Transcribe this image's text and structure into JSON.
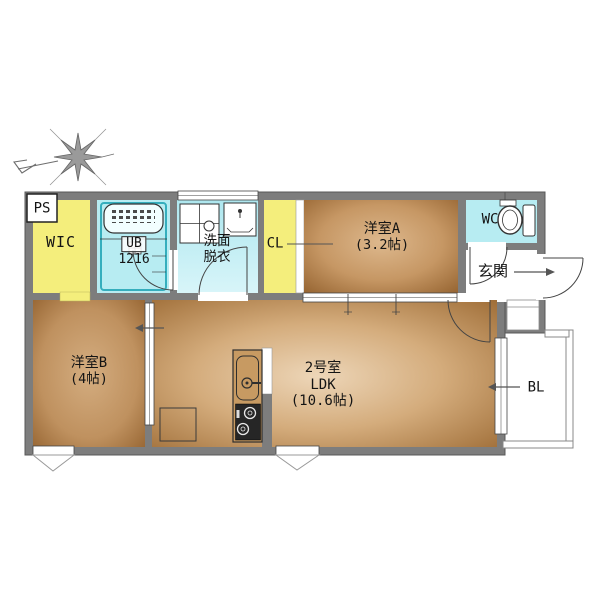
{
  "plan": {
    "labels": {
      "ps": "PS",
      "wic": "WIC",
      "ub_line1": "UB",
      "ub_line2": "1216",
      "washroom_line1": "洗面",
      "washroom_line2": "脱衣",
      "closet": "CL",
      "room_a_name": "洋室A",
      "room_a_size": "(3.2帖)",
      "wc": "WC",
      "entrance": "玄関",
      "ldk_line1": "2号室",
      "ldk_line2": "LDK",
      "ldk_line3": "(10.6帖)",
      "room_b_name": "洋室B",
      "room_b_size": "(4帖)",
      "balcony": "BL"
    },
    "icons": [
      "compass-icon",
      "bathtub-icon",
      "washing-machine-pan-icon",
      "vanity-sink-icon",
      "toilet-icon",
      "kitchen-sink-icon",
      "stove-icon",
      "refrigerator-space-icon",
      "door-arc-icon",
      "sliding-door-arrow-icon",
      "window-icon"
    ],
    "colors": {
      "wall_gray": "#7d7d7d",
      "storage_yellow": "#f4ee7c",
      "wet_area_cyan": "#b7ecf2",
      "room_brown_dark": "#8c5a27",
      "room_brown_light": "#ddb88d",
      "ldk_center": "#edd6b8",
      "balcony_white": "#ffffff"
    }
  }
}
